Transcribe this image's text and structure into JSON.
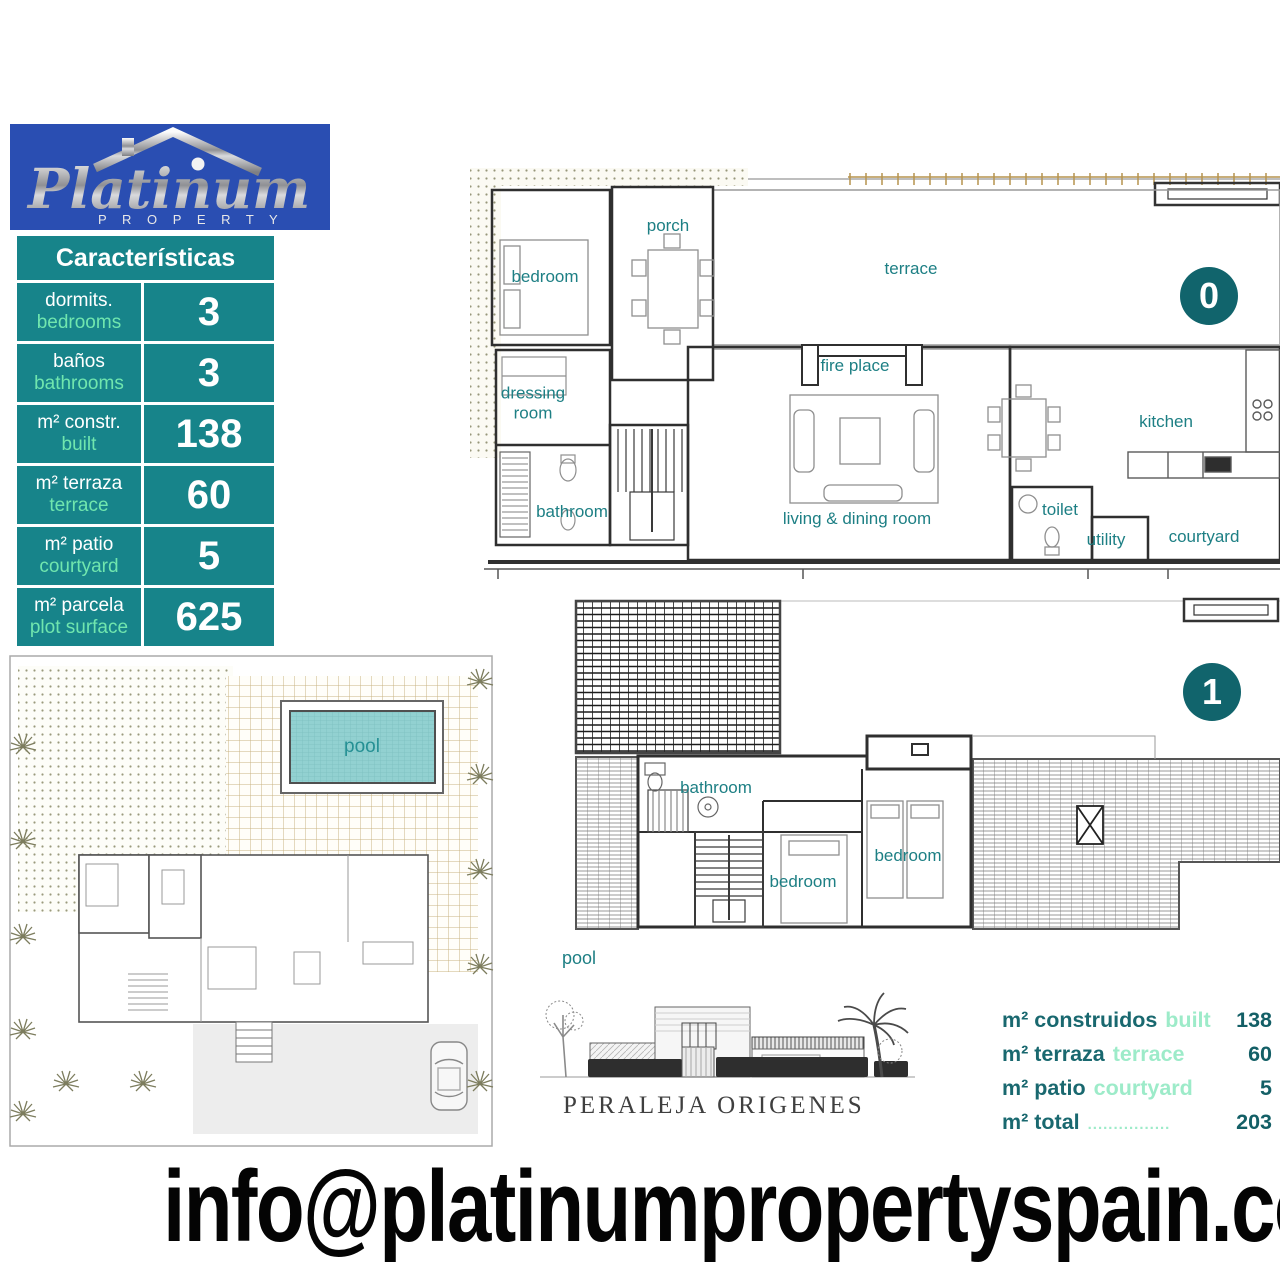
{
  "logo": {
    "brand": "Platinum",
    "sub": "P R O P E R T Y"
  },
  "table": {
    "title": "Características",
    "rows": [
      {
        "es": "dormits.",
        "en": "bedrooms",
        "value": "3"
      },
      {
        "es": "baños",
        "en": "bathrooms",
        "value": "3"
      },
      {
        "es": "m² constr.",
        "en": "built",
        "value": "138"
      },
      {
        "es": "m² terraza",
        "en": "terrace",
        "value": "60"
      },
      {
        "es": "m² patio",
        "en": "courtyard",
        "value": "5"
      },
      {
        "es": "m² parcela",
        "en": "plot surface",
        "value": "625"
      }
    ]
  },
  "plans": {
    "level0": {
      "badge": "0",
      "rooms": {
        "bedroom": "bedroom",
        "porch": "porch",
        "terrace": "terrace",
        "dressing_room": "dressing room",
        "fire_place": "fire place",
        "bathroom": "bathroom",
        "living_dining": "living & dining room",
        "kitchen": "kitchen",
        "toilet": "toilet",
        "utility": "utility",
        "courtyard": "courtyard"
      }
    },
    "level1": {
      "badge": "1",
      "rooms": {
        "bathroom": "bathroom",
        "bedroom_left": "bedroom",
        "bedroom_right": "bedroom"
      },
      "pool_label": "pool"
    },
    "site": {
      "pool_label": "pool"
    }
  },
  "elevation": {
    "caption": "PERALEJA ORIGENES"
  },
  "summary": {
    "rows": [
      {
        "es": "m² construidos",
        "en": "built",
        "value": "138"
      },
      {
        "es": "m² terraza",
        "en": "terrace",
        "value": "60"
      },
      {
        "es": "m² patio",
        "en": "courtyard",
        "value": "5"
      },
      {
        "es": "m² total",
        "en": "................",
        "value": "203"
      }
    ]
  },
  "footer": {
    "email": "info@platinumpropertyspain.com"
  },
  "colors": {
    "teal_table": "#17848a",
    "mint": "#70e6ae",
    "dark_teal_badge": "#11646c",
    "room_label_teal": "#1d7f84",
    "logo_blue": "#2a4eb2",
    "pool_fill": "#92d1d1"
  }
}
